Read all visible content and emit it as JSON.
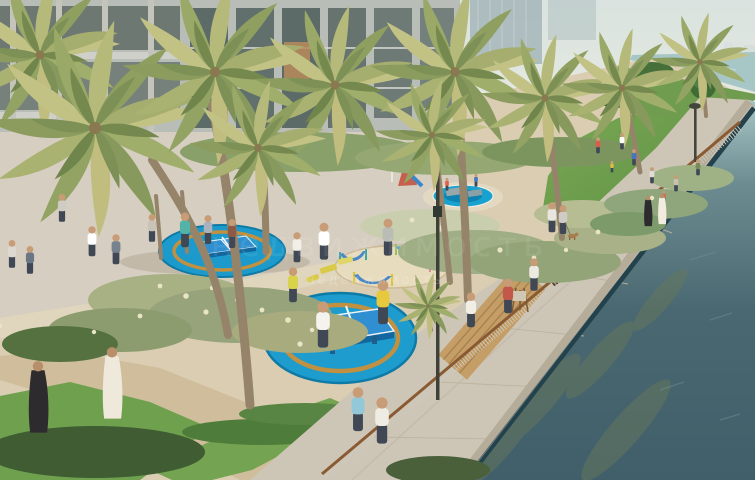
{
  "meta": {
    "kind": "architectural-rendering",
    "subject": "Aerial view of a waterfront park promenade: palm trees, circular blue table-tennis courts, kids splash pool, hammock garden, lawns and a canal-side walkway",
    "width_px": 755,
    "height_px": 480
  },
  "watermark": {
    "text": "недвижимость",
    "style": "semi-transparent white overlay, center of image"
  },
  "palette": {
    "sky": "#d9e3df",
    "skyline": "#dde4e1",
    "sea": "#a7c6c6",
    "canal_mid": "#59777e",
    "canal_deep": "#42606b",
    "algae": "#66775c",
    "wall_cap": "#b6ac9a",
    "waterline": "#24424c",
    "building_wall": "#b9bdb8",
    "building_glass": "#5c6b67",
    "glass_warm": "#b98a5a",
    "tower_haze": "#a9babc",
    "sand": "#dacdb2",
    "plaza": "#d6cec0",
    "path_brown": "#cfbd9c",
    "promenade": "#cdc6b7",
    "lawn": "#71a04f",
    "hedge_dark": "#3f5c33",
    "shrub_sage": "#a3ab7e",
    "shrub_plume": "#e9e4c6",
    "shrub_dark": "#49603a",
    "tree_green": "#3f6b35",
    "palm_light": "#c3c285",
    "palm_mid": "#9fae6a",
    "palm_dark": "#75894f",
    "trunk": "#96846a",
    "circle_blue": "#1b9acb",
    "circle_ring": "#c19040",
    "table_blue": "#2f8fd0",
    "table_side": "#13679e",
    "table_line": "#ffffff",
    "pool_blue": "#17a2cf",
    "pool_deep": "#0d83b2",
    "sand_circle": "#e8dcbe",
    "hammock_blue": "#4a88c8",
    "post_teal": "#3aa79f",
    "post_green": "#93c05e",
    "post_pink": "#d98ba0",
    "lounger_yellow": "#d9ca4a",
    "rail_wood": "#8a5a33",
    "deck_wood": "#c49e66",
    "bench_dark": "#5d4030",
    "skin": "#c79c76",
    "pants": "#3f4854",
    "robe_white": "#efe9dc",
    "robe_black": "#2e2b2e"
  },
  "scene": {
    "sky": {
      "label": "hazy pale sky"
    },
    "skyline": {
      "label": "distant white city skyline on horizon"
    },
    "sea": {
      "label": "pale sea beyond headland"
    },
    "canal": {
      "label": "dark teal canal water with algae patches"
    },
    "buildings": {
      "label": "modern low-rise residences with glass facade and towers behind"
    },
    "promenade": {
      "label": "curved concrete waterfront promenade with wood-top railing"
    },
    "amenities": [
      {
        "name": "table-tennis-circle",
        "count": 2,
        "description": "blue circular courts with golden ring and blue ping-pong table"
      },
      {
        "name": "kids-splash-pool",
        "count": 1
      },
      {
        "name": "hammock-garden",
        "count": 1,
        "description": "sand circle with blue hammocks on colored posts"
      },
      {
        "name": "playground-slide",
        "count": 1
      },
      {
        "name": "sun-loungers",
        "count": 3
      },
      {
        "name": "wooden-deck-bench",
        "count": 1
      },
      {
        "name": "park-bench",
        "count": 1
      },
      {
        "name": "street-lamp",
        "count": 2
      }
    ],
    "vegetation": {
      "palm_trees": 11,
      "ornamental_grasses": true,
      "flowering_shrubs": true,
      "lawns": 4,
      "round_tree": 1
    },
    "people": {
      "count_approx": 30,
      "groups": [
        "plaza walkers",
        "table-tennis players",
        "children at splash pool",
        "families on lawn",
        "couple in traditional dress (white kandura, black abaya) x2",
        "joggers by railing",
        "painter at easel",
        "person walking a dog"
      ]
    }
  }
}
